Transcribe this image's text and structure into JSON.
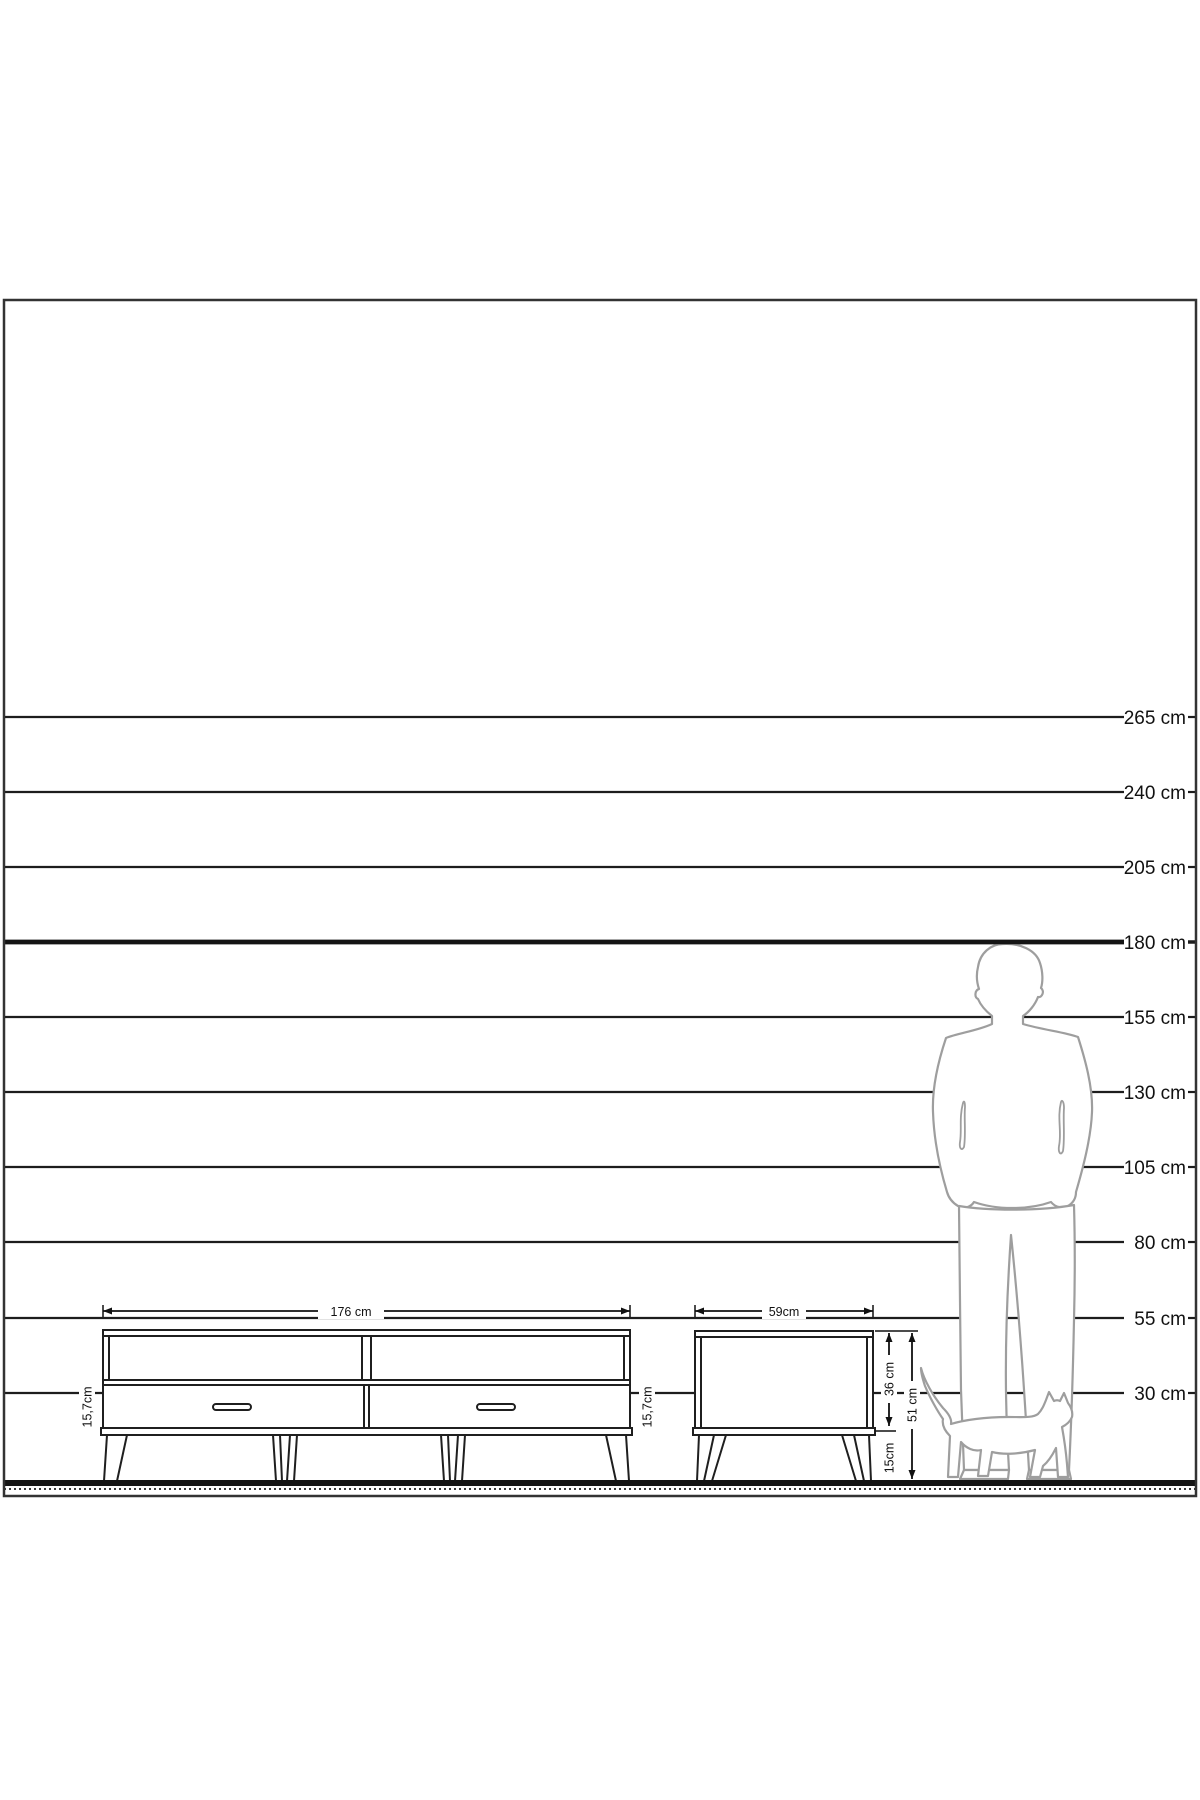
{
  "scale": {
    "lines": [
      {
        "label": "265 cm"
      },
      {
        "label": "240 cm"
      },
      {
        "label": "205 cm"
      },
      {
        "label": "180 cm"
      },
      {
        "label": "155 cm"
      },
      {
        "label": "130 cm"
      },
      {
        "label": "105 cm"
      },
      {
        "label": "80 cm"
      },
      {
        "label": "55 cm"
      },
      {
        "label": "30 cm"
      }
    ]
  },
  "tv_stand": {
    "width_label": "176 cm",
    "drawer_height_left_label": "15,7cm",
    "drawer_height_right_label": "15,7cm"
  },
  "side_table": {
    "width_label": "59cm",
    "body_height_label": "36 cm",
    "leg_height_label": "15cm",
    "total_height_label": "51 cm"
  },
  "colors": {
    "line": "#1d1d1d",
    "dimension": "#111111",
    "silhouette_stroke": "#9e9e9e",
    "background": "#ffffff"
  }
}
